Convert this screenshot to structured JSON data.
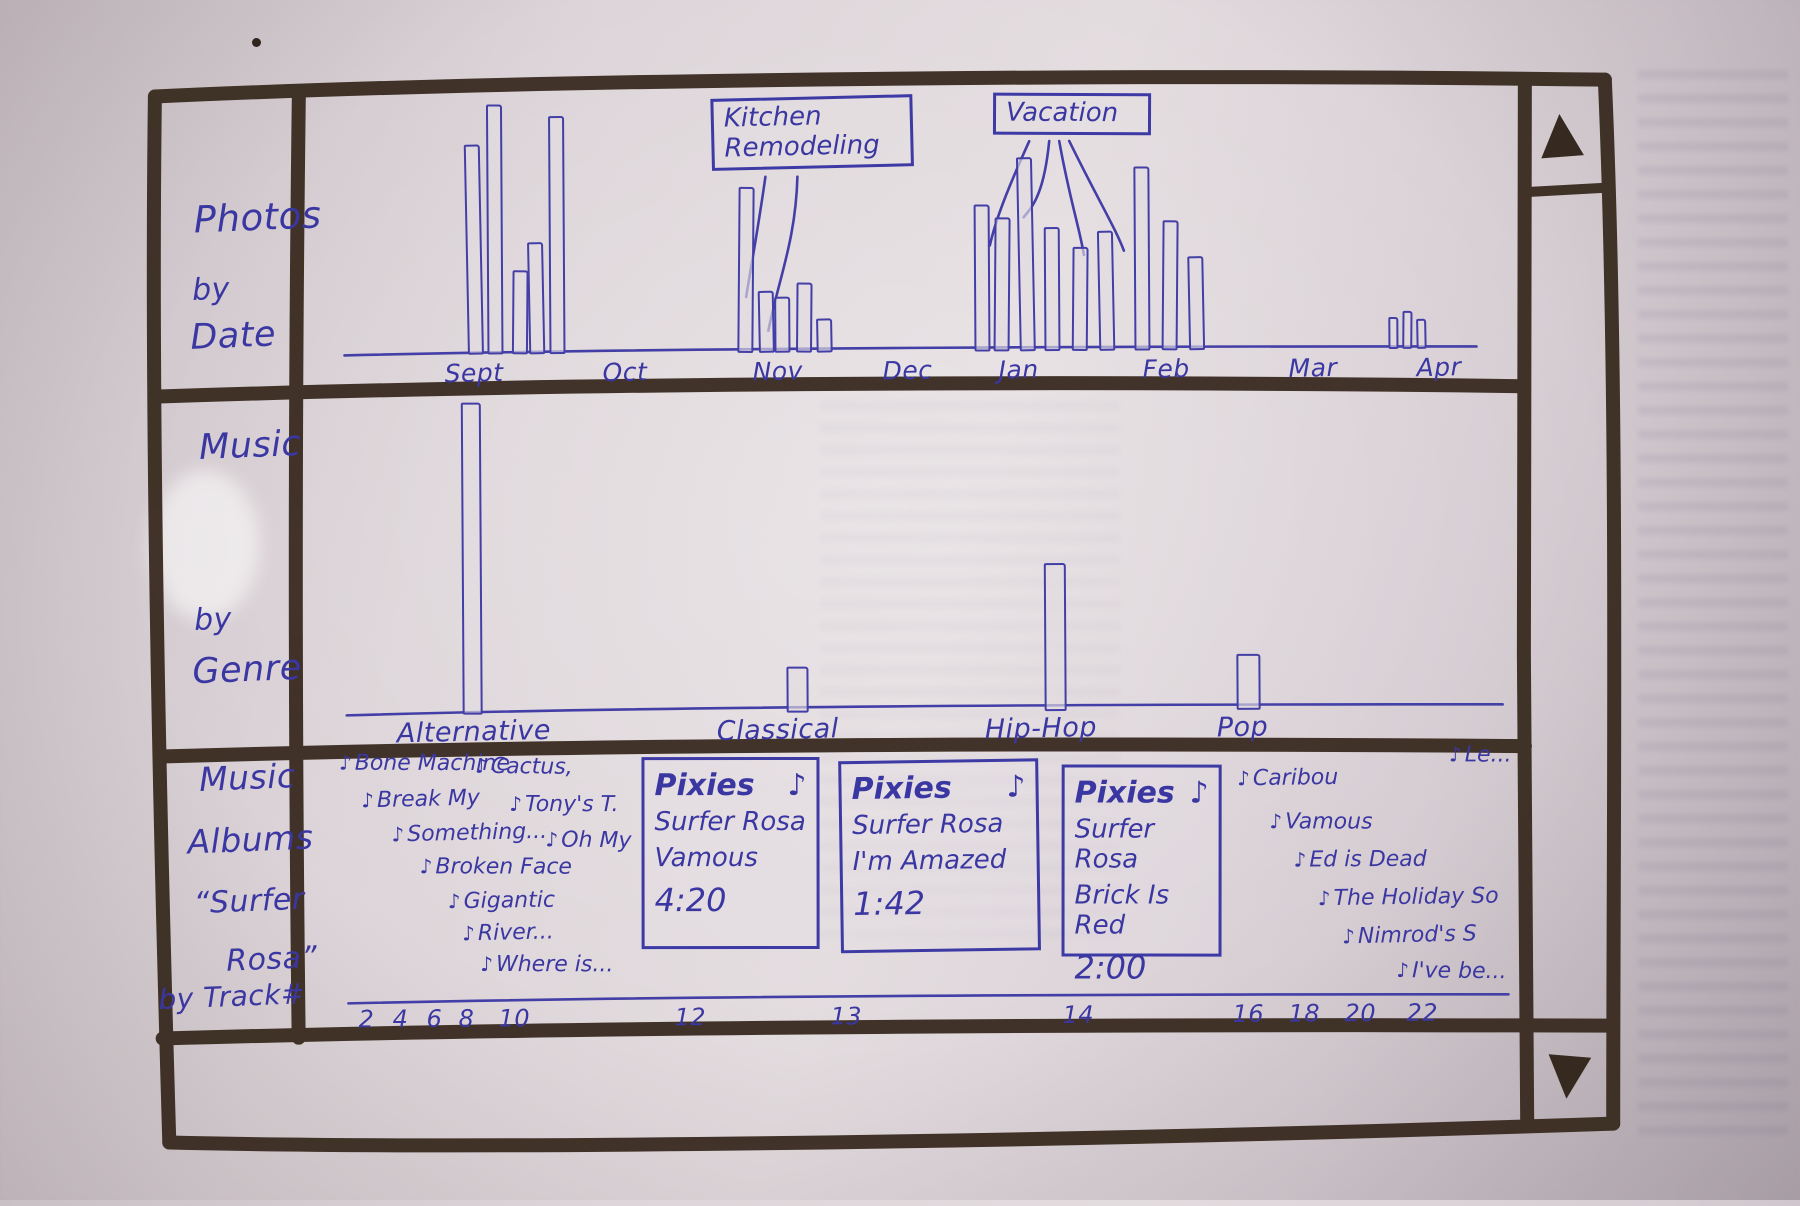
{
  "icons": {
    "music_note": "♪",
    "scroll_up": "▲",
    "scroll_down": "▼"
  },
  "panels": {
    "photos": {
      "title_lines": [
        "Photos",
        "by",
        "Date"
      ]
    },
    "genre": {
      "title_lines": [
        "Music",
        "by",
        "Genre"
      ]
    },
    "albums": {
      "title_lines": [
        "Music",
        "Albums",
        "“Surfer",
        "Rosa”",
        "by Track#"
      ]
    }
  },
  "photos_chart": {
    "type": "bar",
    "title": "Photos by Date",
    "months": [
      {
        "label": "Sept",
        "x": 446
      },
      {
        "label": "Oct",
        "x": 604
      },
      {
        "label": "Nov",
        "x": 754
      },
      {
        "label": "Dec",
        "x": 884
      },
      {
        "label": "Jan",
        "x": 1000
      },
      {
        "label": "Feb",
        "x": 1144
      },
      {
        "label": "Mar",
        "x": 1290
      },
      {
        "label": "Apr",
        "x": 1418
      }
    ],
    "callouts": [
      {
        "label": "Kitchen\nRemodeling"
      },
      {
        "label": "Vacation"
      }
    ],
    "bars": [
      {
        "x": 468,
        "h": 210
      },
      {
        "x": 489,
        "h": 250
      },
      {
        "x": 514,
        "h": 84
      },
      {
        "x": 530,
        "h": 112
      },
      {
        "x": 551,
        "h": 238
      },
      {
        "x": 740,
        "h": 166
      },
      {
        "x": 760,
        "h": 62
      },
      {
        "x": 776,
        "h": 56
      },
      {
        "x": 798,
        "h": 70
      },
      {
        "x": 818,
        "h": 34
      },
      {
        "x": 976,
        "h": 147
      },
      {
        "x": 996,
        "h": 134
      },
      {
        "x": 1020,
        "h": 194
      },
      {
        "x": 1046,
        "h": 124
      },
      {
        "x": 1074,
        "h": 104
      },
      {
        "x": 1100,
        "h": 120
      },
      {
        "x": 1136,
        "h": 184
      },
      {
        "x": 1164,
        "h": 130
      },
      {
        "x": 1190,
        "h": 94
      },
      {
        "x": 1390,
        "h": 32,
        "w": 10
      },
      {
        "x": 1404,
        "h": 38,
        "w": 10
      },
      {
        "x": 1418,
        "h": 30,
        "w": 10
      }
    ]
  },
  "genre_chart": {
    "type": "bar",
    "title": "Music by Genre",
    "categories": [
      {
        "label": "Alternative",
        "label_x": 396,
        "bar_x": 462,
        "h": 312,
        "w": 20
      },
      {
        "label": "Classical",
        "label_x": 716,
        "bar_x": 786,
        "h": 46,
        "w": 22
      },
      {
        "label": "Hip-Hop",
        "label_x": 984,
        "bar_x": 1044,
        "h": 148,
        "w": 22
      },
      {
        "label": "Pop",
        "label_x": 1216,
        "bar_x": 1236,
        "h": 56,
        "w": 24
      }
    ]
  },
  "albums_panel": {
    "title": "Music Albums “Surfer Rosa” by Track#",
    "scatter_left": [
      {
        "label": "Bone Machine",
        "x": 338,
        "y": 748
      },
      {
        "label": "Cactus,",
        "x": 474,
        "y": 752
      },
      {
        "label": "Break My",
        "x": 360,
        "y": 784
      },
      {
        "label": "Tony's T.",
        "x": 508,
        "y": 790
      },
      {
        "label": "Something...",
        "x": 390,
        "y": 818
      },
      {
        "label": "Oh My",
        "x": 544,
        "y": 826
      },
      {
        "label": "Broken Face",
        "x": 418,
        "y": 852
      },
      {
        "label": "Gigantic",
        "x": 446,
        "y": 886
      },
      {
        "label": "River...",
        "x": 460,
        "y": 918
      },
      {
        "label": "Where is...",
        "x": 478,
        "y": 950
      }
    ],
    "cards": [
      {
        "artist": "Pixies",
        "album": "Surfer Rosa",
        "track": "Vamous",
        "time": "4:20"
      },
      {
        "artist": "Pixies",
        "album": "Surfer Rosa",
        "track": "I'm Amazed",
        "time": "1:42"
      },
      {
        "artist": "Pixies",
        "album": "Surfer Rosa",
        "track": "Brick Is Red",
        "time": "2:00"
      }
    ],
    "scatter_right": [
      {
        "label": "Le...",
        "x": 1448,
        "y": 746
      },
      {
        "label": "Caribou",
        "x": 1236,
        "y": 768
      },
      {
        "label": "Vamous",
        "x": 1268,
        "y": 812
      },
      {
        "label": "Ed is Dead",
        "x": 1292,
        "y": 850
      },
      {
        "label": "The Holiday So",
        "x": 1316,
        "y": 888
      },
      {
        "label": "Nimrod's S",
        "x": 1340,
        "y": 926
      },
      {
        "label": "I've be...",
        "x": 1394,
        "y": 962
      }
    ],
    "track_numbers": [
      {
        "n": "2",
        "x": 356
      },
      {
        "n": "4",
        "x": 390
      },
      {
        "n": "6",
        "x": 424
      },
      {
        "n": "8",
        "x": 456
      },
      {
        "n": "10",
        "x": 496
      },
      {
        "n": "12",
        "x": 672
      },
      {
        "n": "13",
        "x": 828
      },
      {
        "n": "14",
        "x": 1060
      },
      {
        "n": "16",
        "x": 1230
      },
      {
        "n": "18",
        "x": 1286
      },
      {
        "n": "20",
        "x": 1342
      },
      {
        "n": "22",
        "x": 1404
      }
    ]
  },
  "colors": {
    "ink_blue": "#3b37a2",
    "marker_dark": "#3a2c21",
    "paper": "#ddd5d9"
  }
}
